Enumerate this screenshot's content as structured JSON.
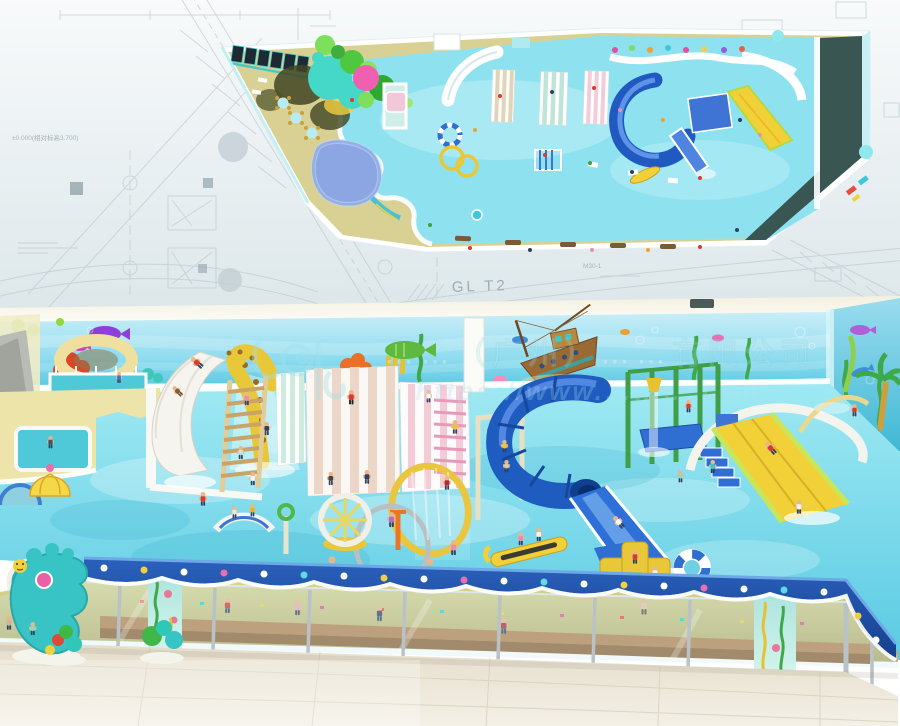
{
  "plan": {
    "label_glt2": "GL T2",
    "label_m30": "M30-1",
    "label_elevation": "±0.000(相对标高3.700)"
  },
  "watermark": {
    "company_text": "……（广州）……有限公司",
    "url_text": "https://www.……….com"
  },
  "colors": {
    "plan_pool": "#8ee2f0",
    "deck_tan": "#d9d094",
    "pool_water_top": "#9fe9f3",
    "pool_water_bottom": "#59cae2",
    "slide_blue": "#1e5cc0",
    "slide_yellow": "#f2d038",
    "fence_blue": "#2456b0",
    "wall_blue": "#a8e4f4",
    "marble_floor": "#ece5d6",
    "dark_band": "#3a5653",
    "cad_line": "#b8c5cc",
    "watermark_cyan": "#9fe0ec"
  }
}
